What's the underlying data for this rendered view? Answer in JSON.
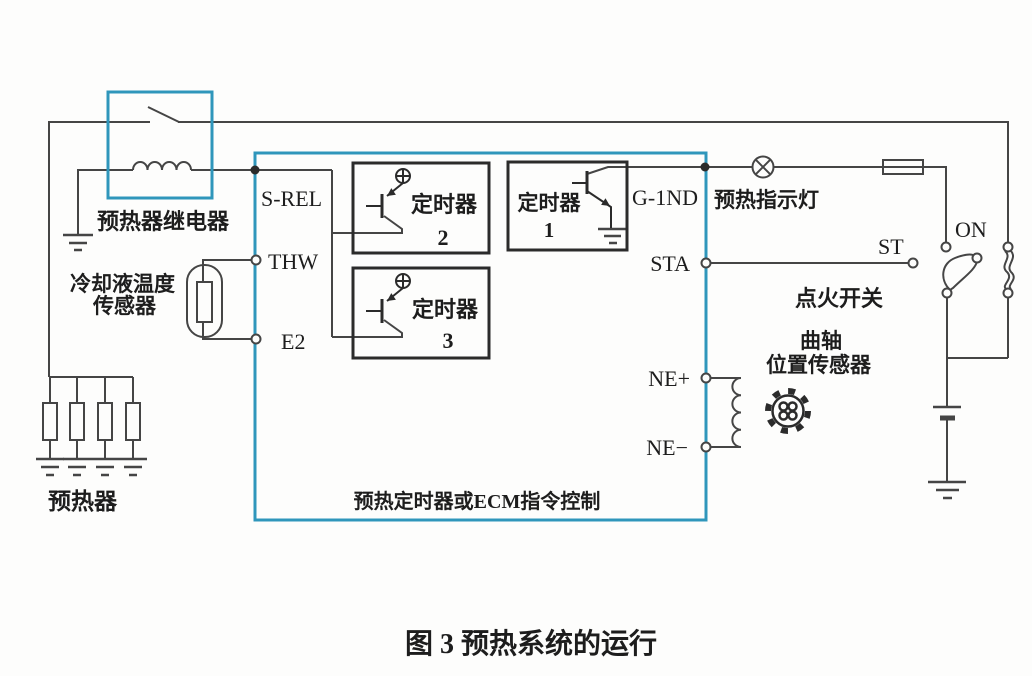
{
  "figure": {
    "caption": "图 3 预热系统的运行"
  },
  "colors": {
    "wire": "#454545",
    "component_blue": "#2f96bb",
    "text": "#1d1d1d",
    "background": "#fdfdfc"
  },
  "relay": {
    "label": "预热器继电器"
  },
  "coolant_sensor": {
    "label_line1": "冷却液温度",
    "label_line2": "传感器"
  },
  "glow_plugs": {
    "label": "预热器",
    "count": 4
  },
  "ecu": {
    "label": "预热定时器或ECM指令控制",
    "terminals_left": [
      "S-REL",
      "THW",
      "E2"
    ],
    "terminals_right": [
      "G-1ND",
      "STA",
      "NE+",
      "NE−"
    ],
    "timers": [
      {
        "label": "定时器",
        "num": "2"
      },
      {
        "label": "定时器",
        "num": "1"
      },
      {
        "label": "定时器",
        "num": "3"
      }
    ]
  },
  "indicator": {
    "label": "预热指示灯"
  },
  "ignition_switch": {
    "label": "点火开关",
    "on": "ON",
    "st": "ST"
  },
  "crank_sensor": {
    "label_line1": "曲轴",
    "label_line2": "位置传感器"
  }
}
